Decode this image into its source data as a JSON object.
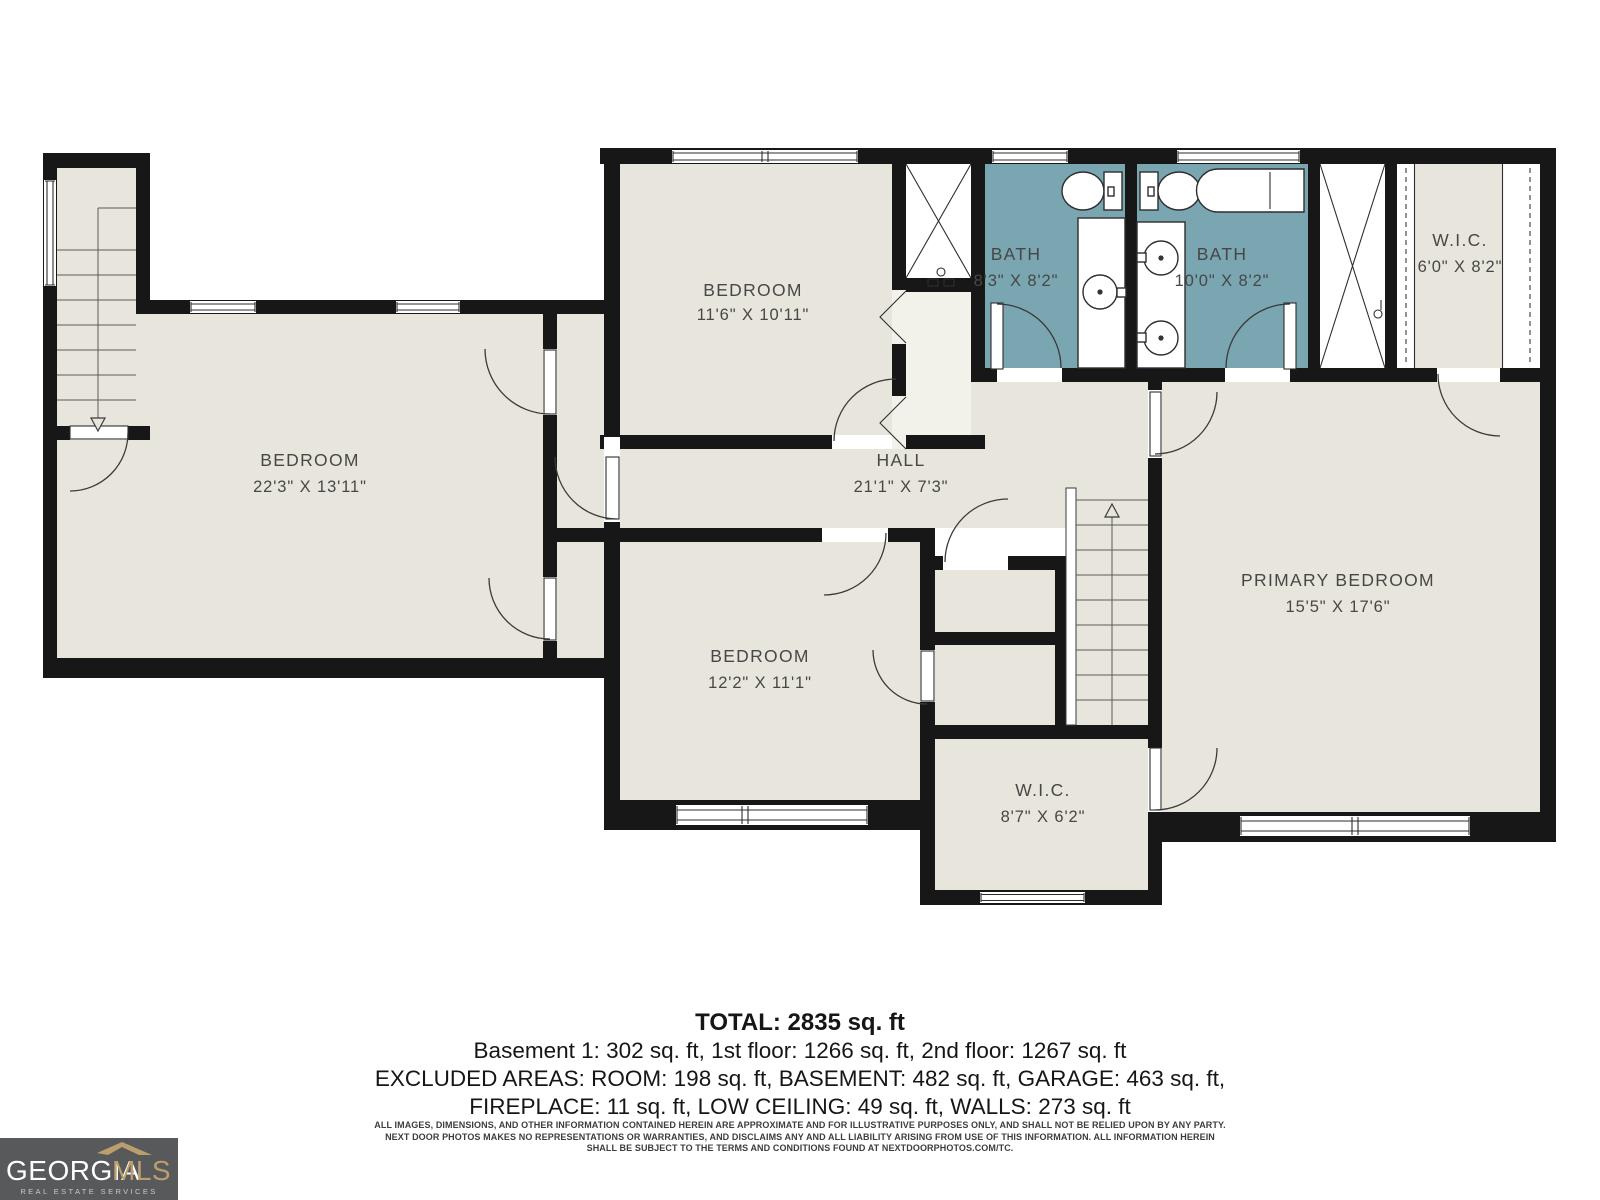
{
  "plan": {
    "colors": {
      "wall": "#171717",
      "room_fill": "#e8e6dc",
      "bath_fill": "#7aa6b1",
      "closet_fill": "#f3f2ea",
      "label": "#474747"
    },
    "rooms": [
      {
        "id": "bedroom-top",
        "name": "BEDROOM",
        "dims": "11'6\" X 10'11\""
      },
      {
        "id": "bath-1",
        "name": "BATH",
        "dims": "8'3\" X 8'2\""
      },
      {
        "id": "bath-2",
        "name": "BATH",
        "dims": "10'0\" X 8'2\""
      },
      {
        "id": "wic-top",
        "name": "W.I.C.",
        "dims": "6'0\" X 8'2\""
      },
      {
        "id": "bedroom-left",
        "name": "BEDROOM",
        "dims": "22'3\" X 13'11\""
      },
      {
        "id": "hall",
        "name": "HALL",
        "dims": "21'1\" X 7'3\""
      },
      {
        "id": "primary-bedroom",
        "name": "PRIMARY BEDROOM",
        "dims": "15'5\" X 17'6\""
      },
      {
        "id": "bedroom-bottom",
        "name": "BEDROOM",
        "dims": "12'2\" X 11'1\""
      },
      {
        "id": "wic-bottom",
        "name": "W.I.C.",
        "dims": "8'7\" X 6'2\""
      }
    ]
  },
  "summary": {
    "total": "TOTAL: 2835 sq. ft",
    "line2": "Basement 1: 302 sq. ft, 1st floor: 1266 sq. ft, 2nd floor: 1267 sq. ft",
    "line3": "EXCLUDED AREAS: ROOM: 198 sq. ft, BASEMENT: 482 sq. ft, GARAGE: 463 sq. ft,",
    "line4": "FIREPLACE: 11 sq. ft, LOW CEILING: 49 sq. ft, WALLS: 273 sq. ft"
  },
  "disclaimer": {
    "line1": "ALL IMAGES, DIMENSIONS, AND OTHER INFORMATION CONTAINED HEREIN ARE APPROXIMATE AND FOR ILLUSTRATIVE PURPOSES ONLY, AND SHALL NOT BE RELIED UPON BY ANY PARTY.",
    "line2": "NEXT DOOR PHOTOS MAKES NO REPRESENTATIONS OR WARRANTIES, AND DISCLAIMS ANY AND ALL LIABILITY ARISING FROM USE OF THIS INFORMATION. ALL INFORMATION HEREIN",
    "line3": "SHALL BE SUBJECT TO THE TERMS AND CONDITIONS FOUND AT NEXTDOORPHOTOS.COM/TC."
  },
  "logo": {
    "name": "GEORGIA",
    "suffix": "MLS",
    "tagline": "REAL ESTATE SERVICES",
    "box_color": "#58595b",
    "gold": "#bb9e6e"
  }
}
